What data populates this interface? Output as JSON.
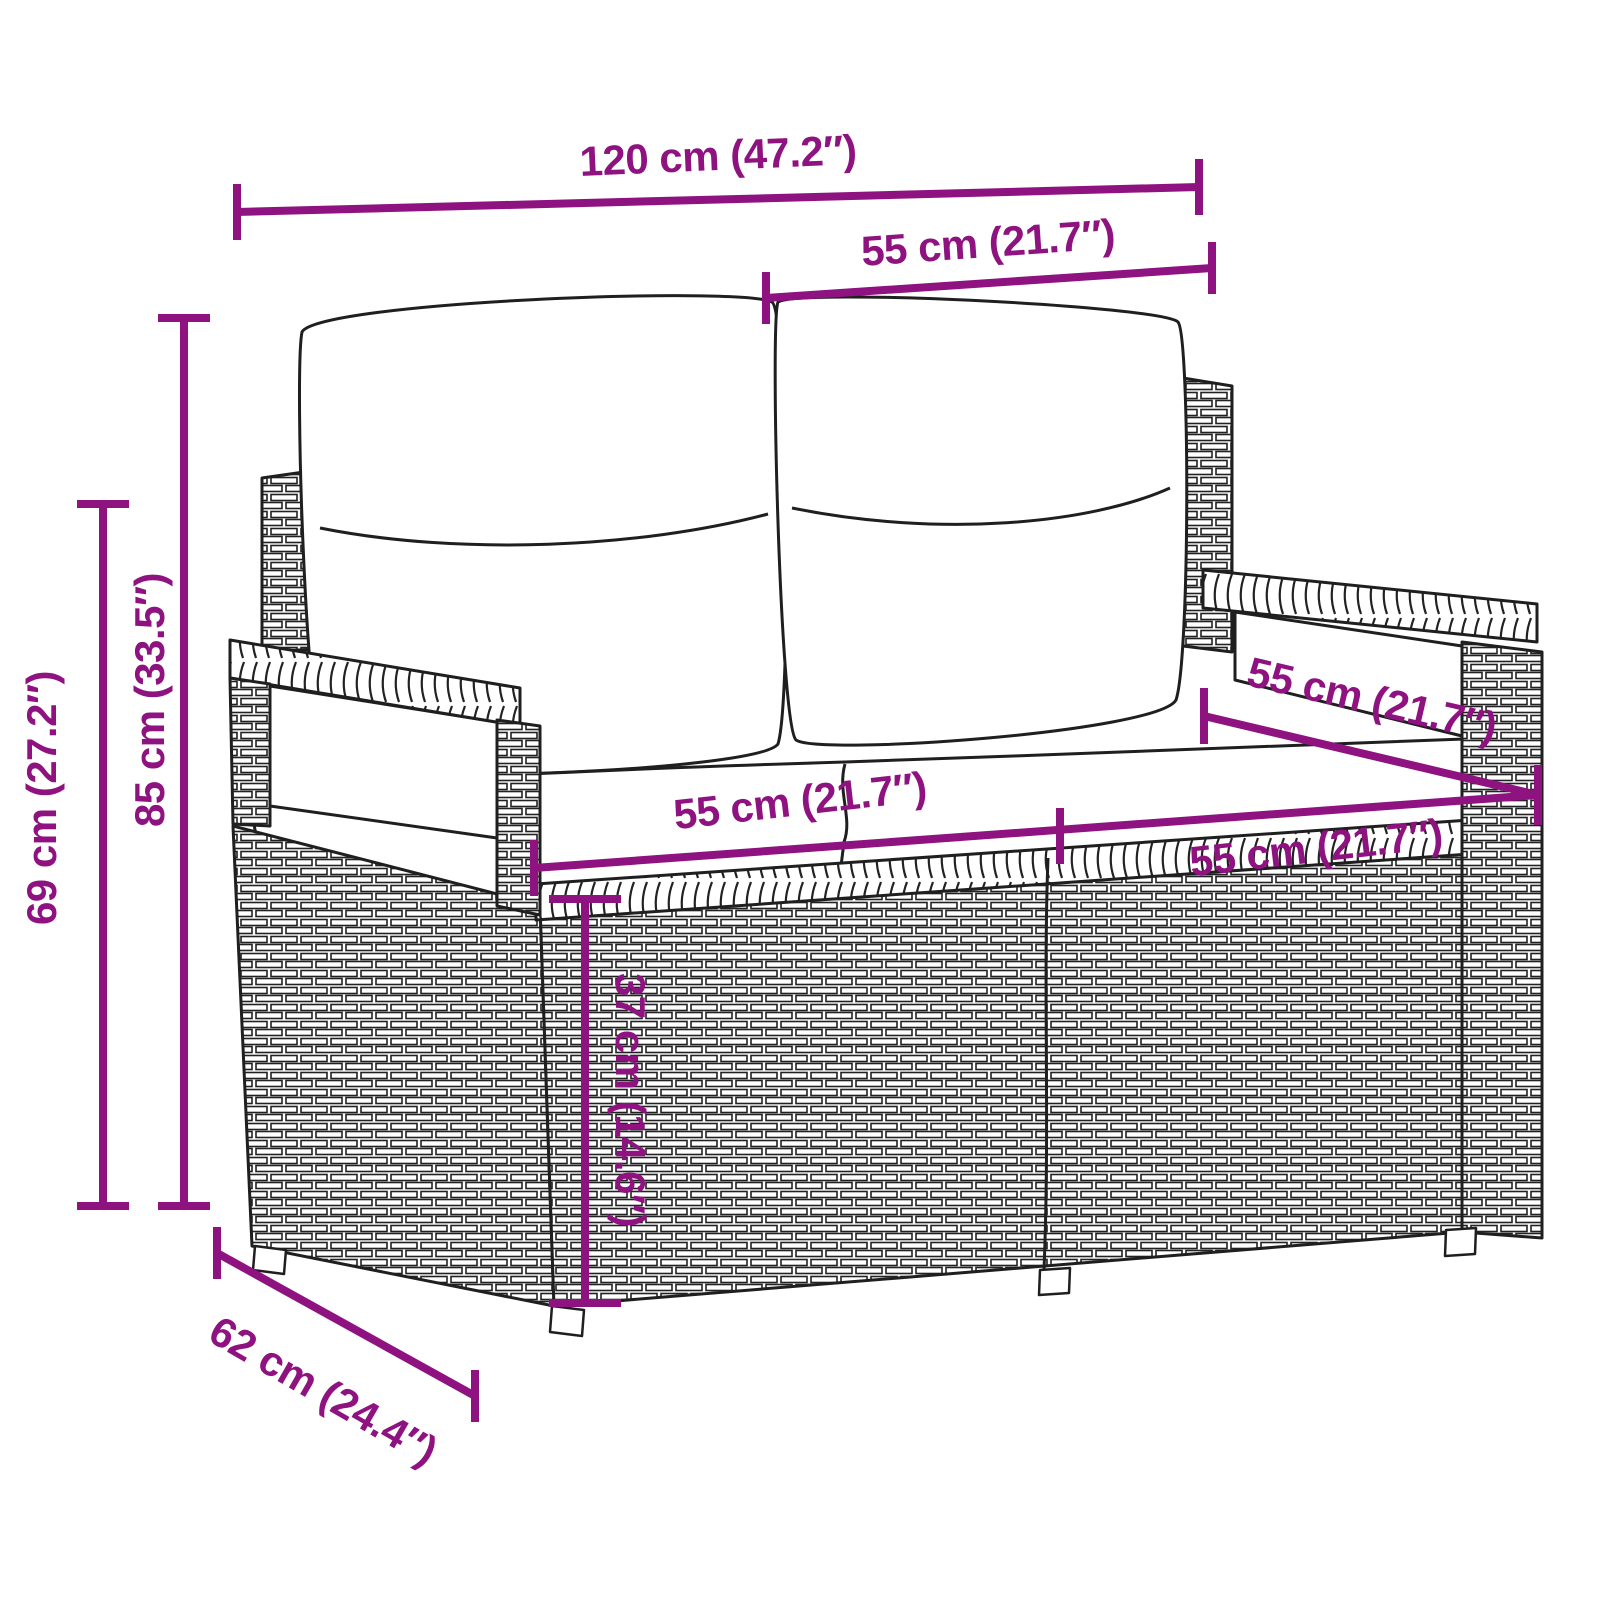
{
  "colors": {
    "dimension_accent": "#8E1280",
    "line_art": "#1f1f1f",
    "background": "#ffffff",
    "cushion_fill": "#ffffff"
  },
  "dimensions": {
    "overall_width": "120 cm (47.2″)",
    "backrest_width": "55 cm (21.7″)",
    "overall_height": "85 cm (33.5″)",
    "armrest_height": "69 cm (27.2″)",
    "seat_width_left": "55 cm (21.7″)",
    "seat_width_right": "55 cm (21.7″)",
    "seat_depth": "55 cm (21.7″)",
    "seat_height": "37 cm (14.6″)",
    "overall_depth": "62 cm (24.4″)"
  }
}
